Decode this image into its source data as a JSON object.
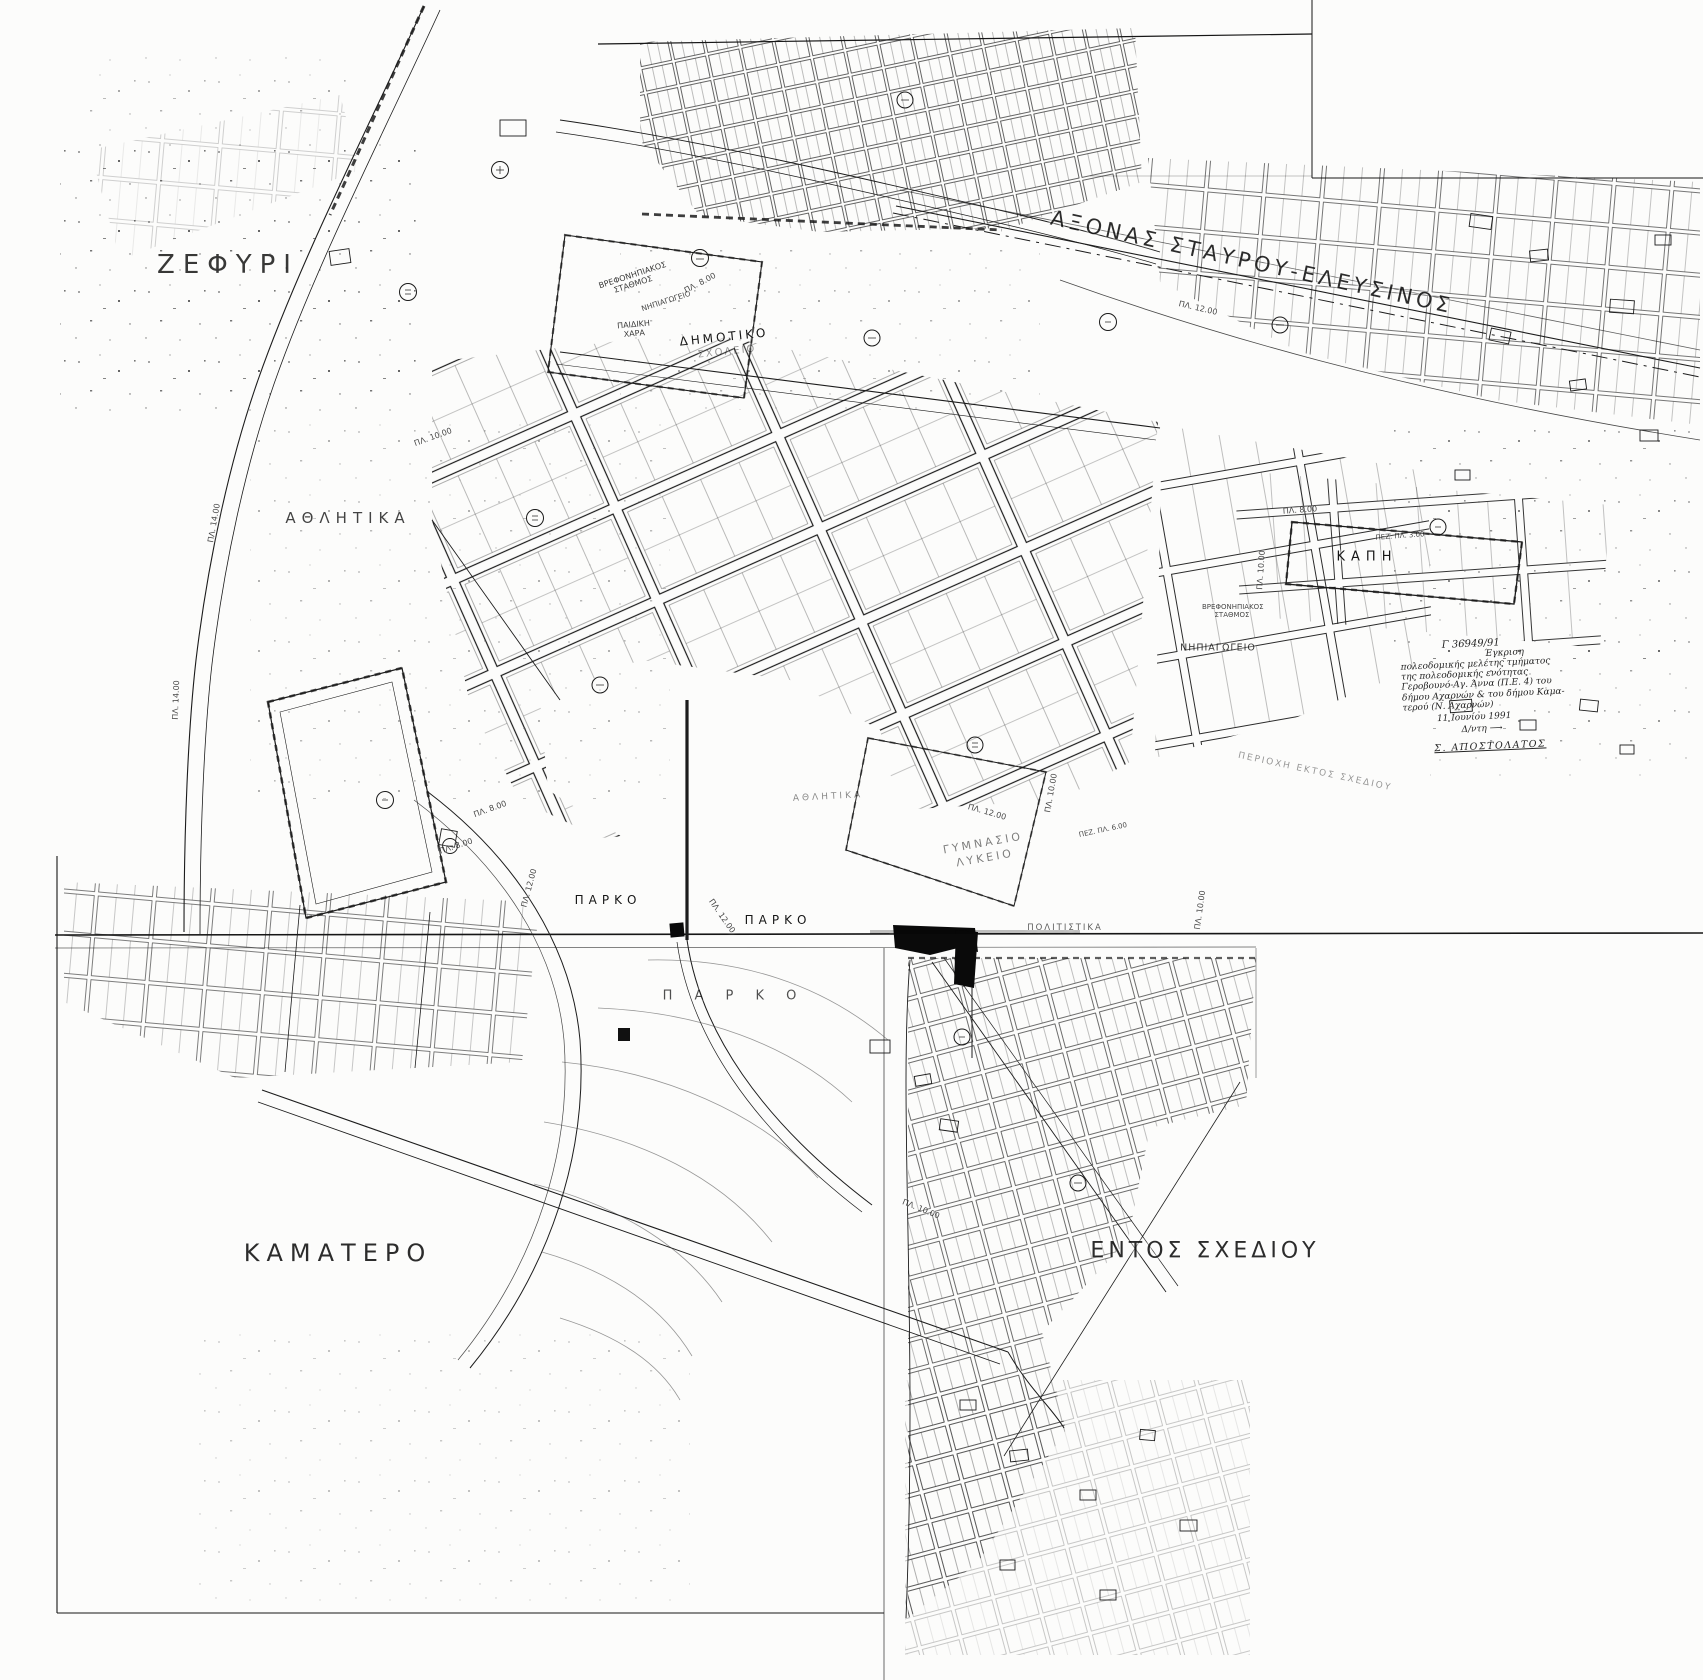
{
  "map": {
    "type": "scanned urban planning map (πολεοδομικό σχέδιο)",
    "ink_color": "#1a1a1a",
    "paper_color": "#fcfcfb"
  },
  "labels": [
    {
      "text": "ΖΕΦΥΡΙ"
    },
    {
      "text": "ΑΞΟΝΑΣ  ΣΤΑΥΡΟΥ-ΕΛΕΥΣΙΝΟΣ"
    },
    {
      "text": "ΑΘΛΗΤΙΚΑ"
    },
    {
      "text": "ΒΡΕΦΟΝΗΠΙΑΚΟΣ ΣΤΑΘΜΟΣ"
    },
    {
      "text": "ΝΗΠΙΑΓΩΓΕΙΟ"
    },
    {
      "text": "ΠΑΙΔΙΚΗ ΧΑΡΑ"
    },
    {
      "text": "ΔΗΜΟΤΙΚΟ"
    },
    {
      "text": "ΣΧΟΛΕΙΟ"
    },
    {
      "text": "ΚΑΠΗ"
    },
    {
      "text": "ΒΡΕΦΟΝΗΠΙΑΚΟΣ ΣΤΑΘΜΟΣ"
    },
    {
      "text": "ΝΗΠΙΑΓΩΓΕΙΟ"
    },
    {
      "text": "ΓΥΜΝΑΣΙΟ"
    },
    {
      "text": "ΛΥΚΕΙΟ"
    },
    {
      "text": "ΠΑΡΚΟ"
    },
    {
      "text": "ΠΑΡΚΟ"
    },
    {
      "text": "Π Α Ρ Κ Ο"
    },
    {
      "text": "ΠΟΛΙΤΙΣΤΙΚΑ"
    },
    {
      "text": "ΚΑΜΑΤΕΡΟ"
    },
    {
      "text": "ΕΝΤΟΣ ΣΧΕΔΙΟΥ"
    },
    {
      "text": "ΠΕΡΙΟΧΗ ΕΚΤΟΣ ΣΧΕΔΙΟΥ"
    },
    {
      "text": "ΑΘΛΗΤΙΚΑ"
    }
  ],
  "road_labels": [
    {
      "text": "ΠΛ. 14.00"
    },
    {
      "text": "ΠΛ. 12.00"
    },
    {
      "text": "ΠΛ. 8.00"
    },
    {
      "text": "ΠΛ. 10.00"
    },
    {
      "text": "ΠΛ. 10.00"
    },
    {
      "text": "ΠΛ. 8.00"
    },
    {
      "text": "ΠΕΖ. ΠΛ. 3.00"
    },
    {
      "text": "ΠΛ. 12.00"
    },
    {
      "text": "ΠΛ. 12.00"
    },
    {
      "text": "ΠΛ. 12.00"
    },
    {
      "text": "ΠΛ. 10.00"
    },
    {
      "text": "ΠΕΖ. ΠΛ. 6.00"
    },
    {
      "text": "ΠΛ. 10.00"
    },
    {
      "text": "ΠΛ. 8.00"
    },
    {
      "text": "ΠΛ. 8.00"
    },
    {
      "text": "ΠΛ. 14.00"
    },
    {
      "text": "ΠΛ. 10.00"
    }
  ],
  "note": {
    "lines": [
      "Γ 36949/91",
      "Έγκριση",
      "πολεοδομικής μελέτης τμήματος",
      "της πολεοδομικής ενότητας",
      "Γεροβουνό-Αγ. Άννα (Π.Ε. 4) του",
      "δήμου Αχαρνών & του δήμου Καμα-",
      "τερού (Ν. Αχαρνών)",
      "11 Ιουνίου 1991",
      "Δ/ντη ⟶",
      "Σ. ΑΠΟΣΤΟΛΑΤΟΣ"
    ]
  }
}
